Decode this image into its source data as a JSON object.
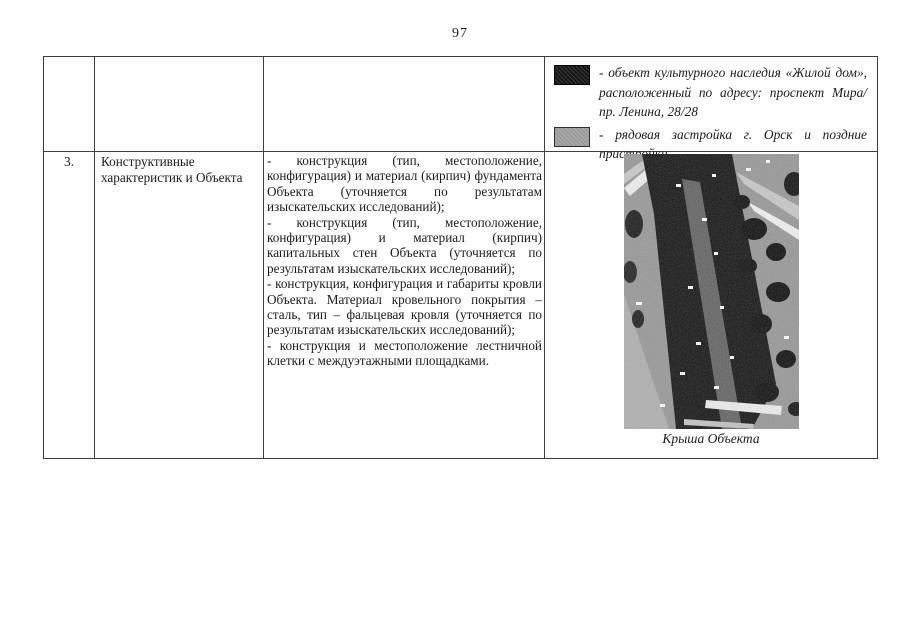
{
  "page": {
    "number": "97"
  },
  "legend": {
    "items": [
      {
        "swatch": "black-swatch",
        "color": "#161616",
        "text": "- объект культурного наследия «Жилой дом», расположенный по адресу: проспект Мира/ пр. Ленина, 28/28"
      },
      {
        "swatch": "gray-swatch",
        "color": "#a8a8a8",
        "text": "- рядовая застройка г. Орск и поздние пристройки"
      }
    ]
  },
  "row": {
    "index": "3.",
    "category": "Конструктивные характеристик и Объекта",
    "paragraphs": [
      "- конструкция (тип, местоположение, конфигурация) и материал (кирпич) фундамента Объекта (уточняется по результатам изыскательских исследований);",
      "- конструкция (тип, местоположение, конфигурация) и материал (кирпич) капитальных стен Объекта (уточняется по результатам изыскательских исследований);",
      "- конструкция, конфигурация и габариты кровли Объекта. Материал кровельного покрытия – сталь, тип – фальцевая кровля (уточняется по результатам изыскательских исследований);",
      "- конструкция и местоположение лестничной клетки с междуэтажными площадками."
    ],
    "photo": {
      "caption": "Крыша Объекта"
    }
  },
  "colors": {
    "swatch_black": "#161616",
    "swatch_gray": "#a8a8a8",
    "table_border": "#3b3b3b"
  }
}
